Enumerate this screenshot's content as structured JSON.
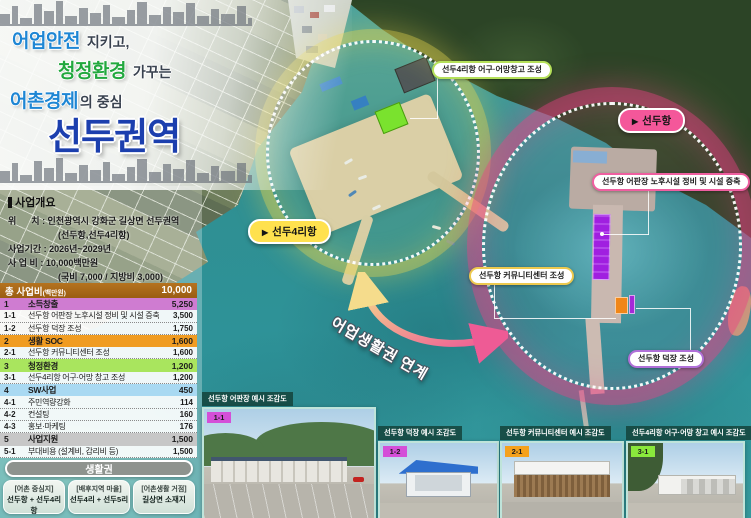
{
  "title": {
    "line1": {
      "em": "어업안전",
      "rest": "지키고,"
    },
    "line2": {
      "em": "청정환경",
      "rest": "가꾸는"
    },
    "line3": {
      "em": "어촌경제",
      "rest": "의 중심"
    },
    "main": "선두권역"
  },
  "overview": {
    "heading": "사업개요",
    "lines": [
      {
        "text": "위      치 : 인천광역시 강화군 길상면 선두권역"
      },
      {
        "text": "(선두항,선두4리항)"
      },
      {
        "text": "사업기간 : 2026년~2029년"
      },
      {
        "text": "사 업 비 : 10,000백만원"
      },
      {
        "text": "(국비 7,000 / 지방비 3,000)"
      }
    ]
  },
  "budget": {
    "header": {
      "title": "총 사업비",
      "unit": "(백만원)",
      "value": "10,000"
    },
    "rows": [
      {
        "no": "1",
        "label": "소득창출",
        "value": "5,250"
      },
      {
        "no": "1-1",
        "label": "선두항 어판장 노후시설 정비 및 시설 증축",
        "value": "3,500"
      },
      {
        "no": "1-2",
        "label": "선두항 덕장 조성",
        "value": "1,750"
      },
      {
        "no": "2",
        "label": "생활 SOC",
        "value": "1,600"
      },
      {
        "no": "2-1",
        "label": "선두항 커뮤니티센터 조성",
        "value": "1,600"
      },
      {
        "no": "3",
        "label": "청정환경",
        "value": "1,200"
      },
      {
        "no": "3-1",
        "label": "선두4리항 어구·어망 창고 조성",
        "value": "1,200"
      },
      {
        "no": "4",
        "label": "SW사업",
        "value": "450"
      },
      {
        "no": "4-1",
        "label": "주민역량강화",
        "value": "114"
      },
      {
        "no": "4-2",
        "label": "컨설팅",
        "value": "160"
      },
      {
        "no": "4-3",
        "label": "홍보·마케팅",
        "value": "176"
      },
      {
        "no": "5",
        "label": "사업지원",
        "value": "1,500"
      },
      {
        "no": "5-1",
        "label": "부대비용 (설계비, 감리비 등)",
        "value": "1,500"
      }
    ]
  },
  "livelihood": {
    "heading": "생활권",
    "zones": [
      {
        "tag": "[어촌 중심지]",
        "name": "선두항 + 선두4리항"
      },
      {
        "tag": "[배후지역 마을]",
        "name": "선두4리 + 선두5리"
      },
      {
        "tag": "[어촌생활 거점]",
        "name": "길상면 소재지"
      }
    ]
  },
  "map": {
    "port_labels": [
      {
        "arrow": "▶",
        "name": "선두4리항"
      },
      {
        "arrow": "▶",
        "name": "선두항"
      }
    ],
    "callouts": [
      "선두4리항 어구·어망창고 조성",
      "선두항 어판장 노후시설 정비 및 시설 증축",
      "선두항 커뮤니티센터 조성",
      "선두항 덕장 조성"
    ],
    "link_label": "어업생활권 연계"
  },
  "photos": [
    {
      "badge": "1-1",
      "title": "선두항 어판장 예시 조감도"
    },
    {
      "badge": "1-2",
      "title": "선두항 덕장 예시 조감도"
    },
    {
      "badge": "2-1",
      "title": "선두항 커뮤니티센터 예시 조감도"
    },
    {
      "badge": "3-1",
      "title": "선두4리항 어구·어망 창고 예시 조감도"
    }
  ],
  "colors": {
    "accent_blue": "#1e86d4",
    "accent_green": "#22a83e",
    "title_blue": "#1c3fae",
    "budget_header": "#a8681b",
    "cat1_income": "#cf7cd1",
    "cat2_soc": "#f09c22",
    "cat3_clean": "#a9e55e",
    "cat4_sw": "#a9d9f2",
    "cat5_support": "#c7c7c7",
    "zone_seondu4ri": "#ffe14e",
    "zone_seonduhang": "#f4579a"
  }
}
